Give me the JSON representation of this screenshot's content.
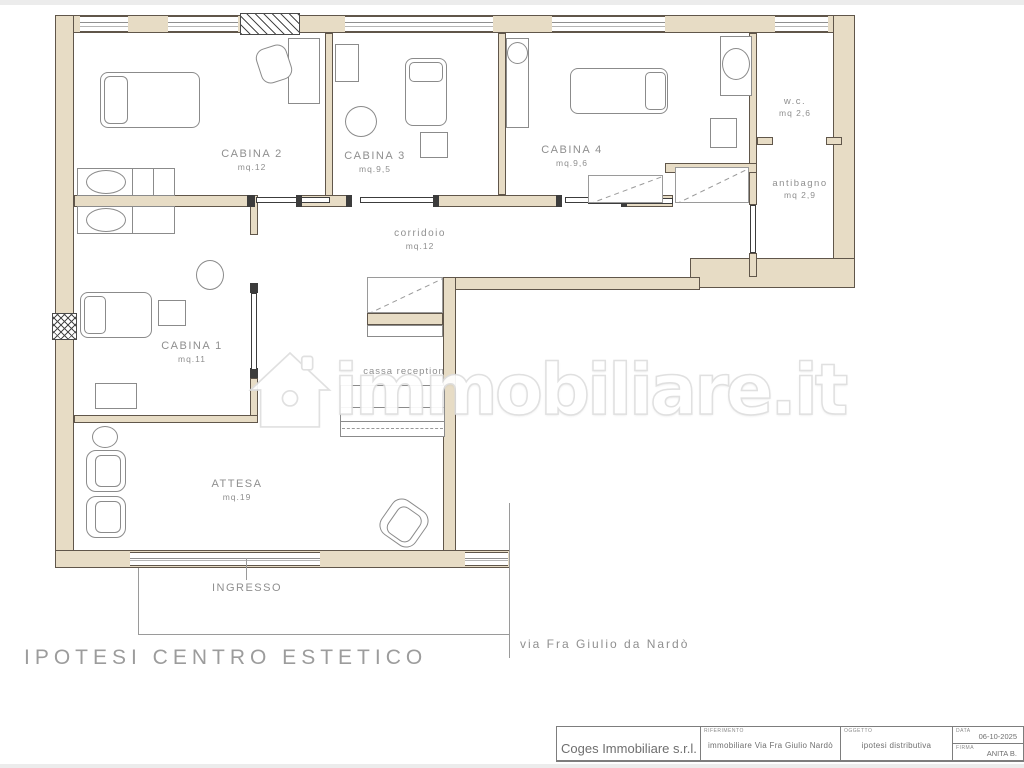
{
  "plan": {
    "title": "IPOTESI  CENTRO  ESTETICO",
    "street": "via  Fra  Giulio  da  Nardò",
    "rooms": {
      "cabina1": {
        "name": "CABINA  1",
        "area": "mq.11"
      },
      "cabina2": {
        "name": "CABINA  2",
        "area": "mq.12"
      },
      "cabina3": {
        "name": "CABINA  3",
        "area": "mq.9,5"
      },
      "cabina4": {
        "name": "CABINA  4",
        "area": "mq.9,6"
      },
      "wc": {
        "name": "w.c.",
        "area": "mq  2,6"
      },
      "antibagno": {
        "name": "antibagno",
        "area": "mq  2,9"
      },
      "corridoio": {
        "name": "corridoio",
        "area": "mq.12"
      },
      "cassa": {
        "name": "cassa  reception"
      },
      "attesa": {
        "name": "ATTESA",
        "area": "mq.19"
      },
      "ingresso": {
        "name": "INGRESSO"
      }
    }
  },
  "watermark": {
    "text": "immobiliare.it"
  },
  "titleblock": {
    "company": "Coges Immobiliare s.r.l.",
    "riferimento_label": "RIFERIMENTO",
    "riferimento_value": "immobiliare Via Fra Giulio Nardò",
    "oggetto_label": "OGGETTO",
    "oggetto_value": "ipotesi distributiva",
    "data_label": "DATA",
    "data_value": "06-10-2025",
    "firma_label": "FIRMA",
    "firma_value": "ANITA B."
  },
  "colors": {
    "wall_fill": "#e7dcc5",
    "wall_line": "#60564a",
    "furniture_line": "#8b8b8b",
    "label_text": "#8f8f8f",
    "watermark": "#ffffff"
  }
}
